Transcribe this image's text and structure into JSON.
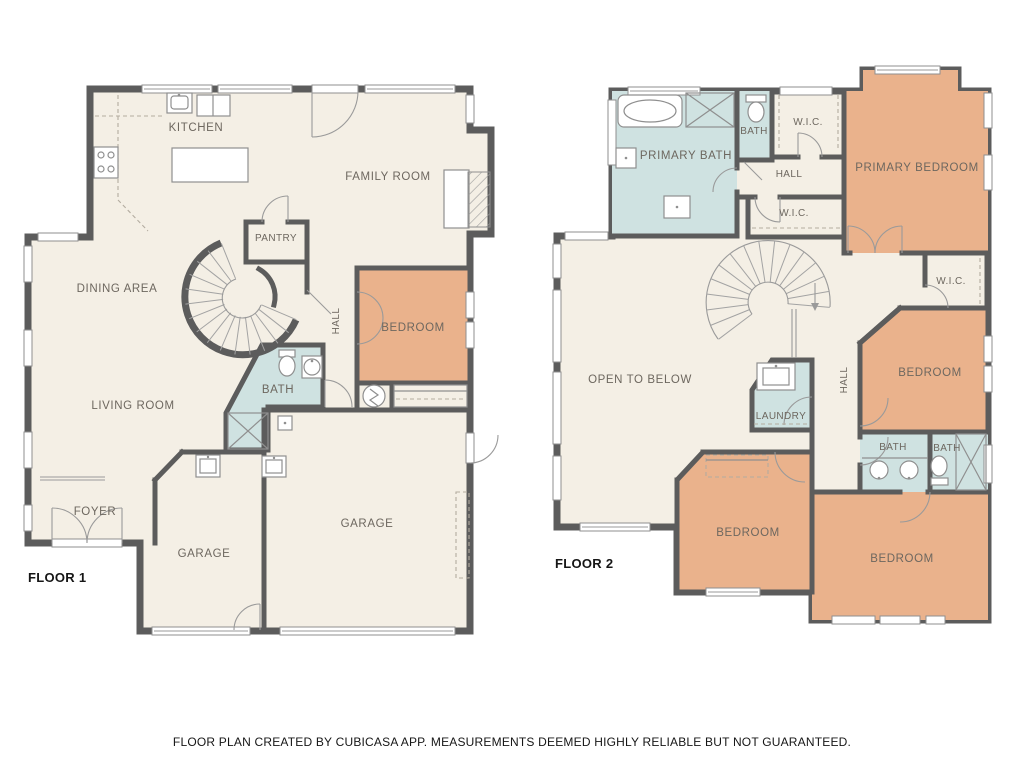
{
  "caption": "FLOOR PLAN CREATED BY CUBICASA APP. MEASUREMENTS DEEMED HIGHLY RELIABLE BUT NOT GUARANTEED.",
  "colors": {
    "background": "#ffffff",
    "floor": "#f4efe5",
    "bedroom_fill": "#eab28c",
    "bath_fill": "#cfe2e1",
    "wall": "#5c5c5c",
    "label": "#6d675f",
    "title_text": "#161616"
  },
  "floor1": {
    "title": "FLOOR 1",
    "rooms": {
      "kitchen": "KITCHEN",
      "family_room": "FAMILY ROOM",
      "pantry": "PANTRY",
      "dining_area": "DINING AREA",
      "bedroom": "BEDROOM",
      "hall": "HALL",
      "bath": "BATH",
      "living_room": "LIVING ROOM",
      "foyer": "FOYER",
      "garage_left": "GARAGE",
      "garage_right": "GARAGE"
    }
  },
  "floor2": {
    "title": "FLOOR 2",
    "rooms": {
      "primary_bath": "PRIMARY BATH",
      "bath_top": "BATH",
      "wic_top": "W.I.C.",
      "hall_top": "HALL",
      "primary_bedroom": "PRIMARY BEDROOM",
      "wic_mid": "W.I.C.",
      "wic_right": "W.I.C.",
      "open_to_below": "OPEN TO BELOW",
      "laundry": "LAUNDRY",
      "hall": "HALL",
      "bedroom_right": "BEDROOM",
      "bath_left": "BATH",
      "bath_right": "BATH",
      "bedroom_bottom_left": "BEDROOM",
      "bedroom_bottom_right": "BEDROOM"
    }
  }
}
